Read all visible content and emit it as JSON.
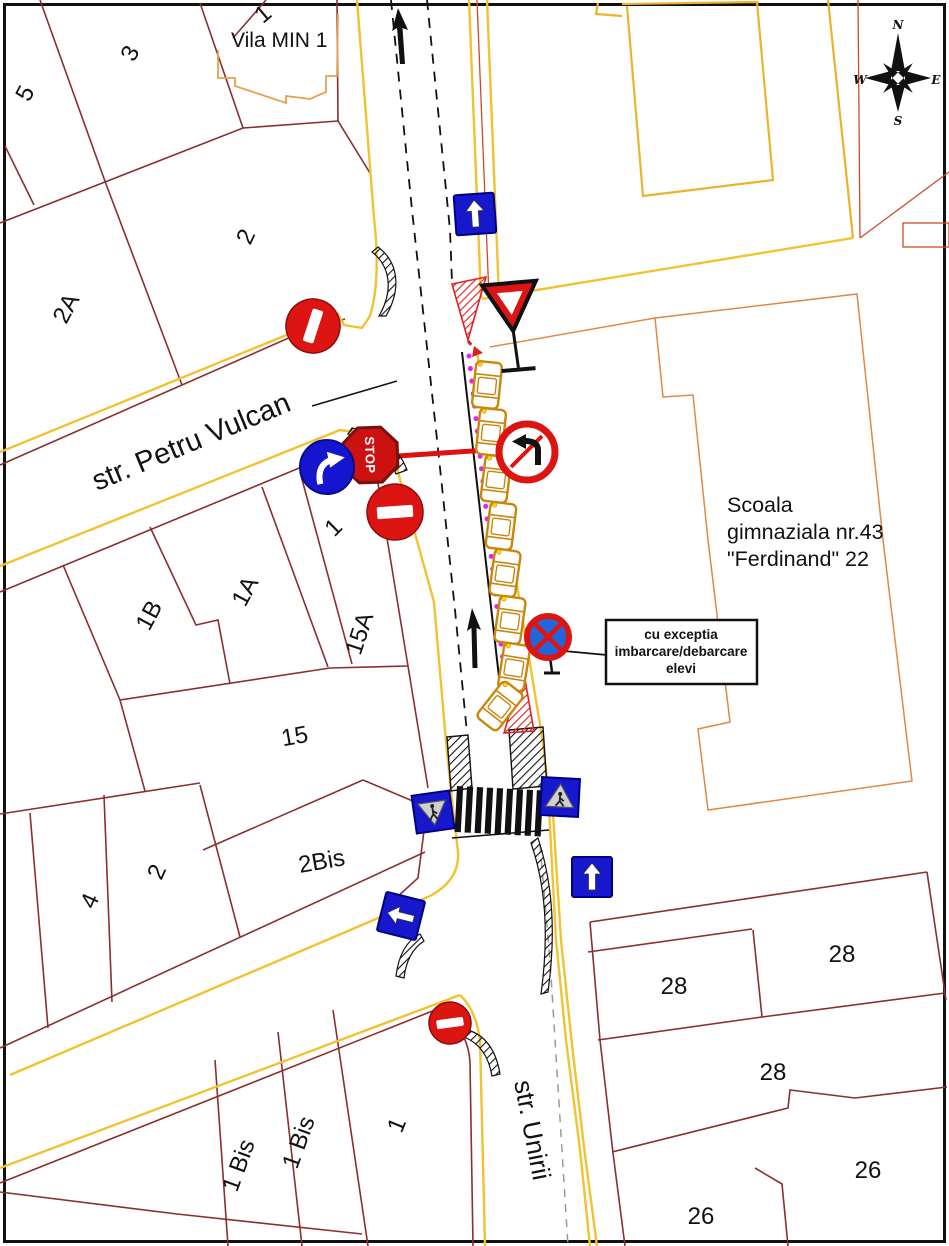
{
  "map_title": "traffic-plan",
  "streets": {
    "petru_vulcan": "str. Petru Vulcan",
    "unirii": "str. Unirii"
  },
  "landmarks": {
    "vila": "Vila MIN 1",
    "school_line1": "Scoala",
    "school_line2": "gimnaziala nr.43",
    "school_line3": "\"Ferdinand\" 22"
  },
  "note_box": {
    "line1": "cu exceptia",
    "line2": "imbarcare/debarcare",
    "line3": "elevi"
  },
  "compass": {
    "north": "N",
    "east": "E",
    "south": "S",
    "west": "W"
  },
  "signs": {
    "stop_label": "STOP",
    "list": [
      {
        "type": "one-way-ahead"
      },
      {
        "type": "yield"
      },
      {
        "type": "no-entry"
      },
      {
        "type": "stop"
      },
      {
        "type": "mandatory-right-turn"
      },
      {
        "type": "no-entry"
      },
      {
        "type": "no-left-turn"
      },
      {
        "type": "no-stopping"
      },
      {
        "type": "pedestrian-crossing"
      },
      {
        "type": "pedestrian-crossing"
      },
      {
        "type": "one-way-ahead"
      },
      {
        "type": "one-way-left"
      },
      {
        "type": "no-entry"
      }
    ]
  },
  "parcels": [
    {
      "label": "1"
    },
    {
      "label": "3"
    },
    {
      "label": "5"
    },
    {
      "label": "2"
    },
    {
      "label": "2A"
    },
    {
      "label": "1B"
    },
    {
      "label": "1A"
    },
    {
      "label": "15A"
    },
    {
      "label": "1"
    },
    {
      "label": "15"
    },
    {
      "label": "2Bis"
    },
    {
      "label": "2"
    },
    {
      "label": "4"
    },
    {
      "label": "1"
    },
    {
      "label": "1 Bis"
    },
    {
      "label": "1 Bis"
    },
    {
      "label": "28"
    },
    {
      "label": "28"
    },
    {
      "label": "28"
    },
    {
      "label": "26"
    },
    {
      "label": "26"
    }
  ],
  "cars": {
    "parked_count": 8,
    "maneuvering_count": 1
  },
  "colors": {
    "parcel_line": "#8a2f2f",
    "road_edge": "#f1c232",
    "building": "#e8a050",
    "sign_red": "#dd1512",
    "sign_blue": "#1717ce",
    "marker_magenta": "#e822e8",
    "car_orange": "#c8860b"
  }
}
